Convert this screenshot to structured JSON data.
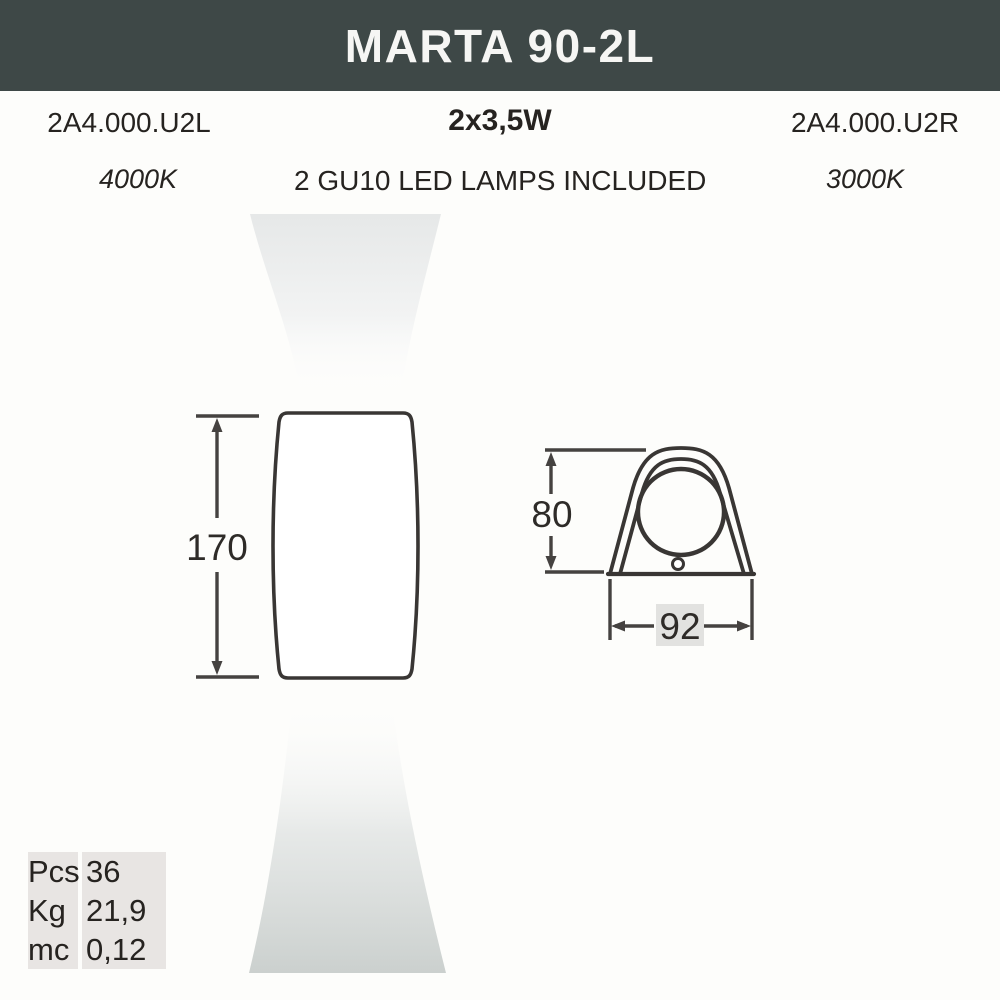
{
  "header": {
    "title": "MARTA 90-2L",
    "bg_color": "#3e4847",
    "text_color": "#f6f6f4"
  },
  "products": {
    "left": {
      "code": "2A4.000.U2L",
      "color_temp": "4000K"
    },
    "center": {
      "wattage": "2x3,5W",
      "lamps": "2 GU10 LED LAMPS INCLUDED"
    },
    "right": {
      "code": "2A4.000.U2R",
      "color_temp": "3000K"
    }
  },
  "drawing": {
    "front_view": {
      "height_label": "170"
    },
    "side_view": {
      "height_label": "80",
      "width_label": "92"
    },
    "units": "mm",
    "line_color": "#393634",
    "beam_top_color": "#e6e8e8",
    "beam_bottom_color": "#cbd0ce"
  },
  "packaging": {
    "rows": [
      {
        "label": "Pcs",
        "value": "36"
      },
      {
        "label": "Kg",
        "value": "21,9"
      },
      {
        "label": "mc",
        "value": "0,12"
      }
    ]
  }
}
